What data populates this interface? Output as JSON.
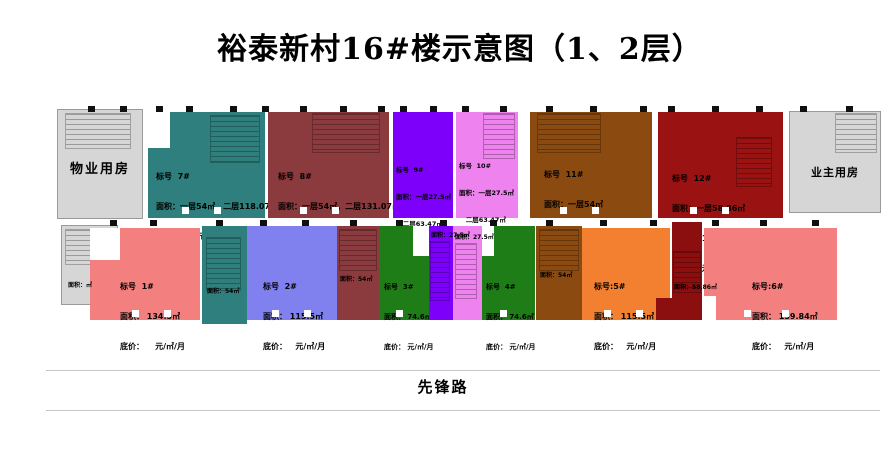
{
  "title": "裕泰新村16#楼示意图（1、2层）",
  "road": {
    "label": "先锋路"
  },
  "rooms": {
    "property": "物业用房",
    "owner": "业主用房"
  },
  "top_units": {
    "u7": {
      "id": "7#",
      "lines": [
        "标号  7#",
        "面积：一层54㎡，二层118.07㎡",
        "底价：      元/㎡/月"
      ]
    },
    "u8": {
      "id": "8#",
      "lines": [
        "标号  8#",
        "面积：一层54㎡，二层131.07㎡",
        "底价：    元/㎡/月"
      ]
    },
    "u9": {
      "id": "9#",
      "lines": [
        "标号  9#",
        "面积：一层27.5㎡",
        "   二层63.47㎡",
        "底价： 元/㎡/月"
      ]
    },
    "u10": {
      "id": "10#",
      "lines": [
        "标号  10#",
        "面积：一层27.5㎡",
        "   二层63.47㎡",
        "底价： 元/㎡/月"
      ]
    },
    "u11": {
      "id": "11#",
      "lines": [
        "标号  11#",
        "面积：一层54㎡",
        "   二层131.07㎡",
        "底价：   元/㎡/月"
      ]
    },
    "u12": {
      "id": "12#",
      "lines": [
        "标号  12#",
        "面积：一层58.86㎡",
        "   二层118㎡",
        "底价：  元/㎡/月"
      ]
    }
  },
  "bottom_units": {
    "u1": {
      "id": "1#",
      "lines": [
        "标号  1#",
        "面积： 134.5㎡",
        "底价：    元/㎡/月"
      ]
    },
    "u2": {
      "id": "2#",
      "lines": [
        "标号  2#",
        "面积： 115.5㎡",
        "底价：   元/㎡/月"
      ]
    },
    "u3": {
      "id": "3#",
      "lines": [
        "标号  3#",
        "面积： 74.6㎡",
        "底价： 元/㎡/月"
      ]
    },
    "u4": {
      "id": "4#",
      "lines": [
        "标号  4#",
        "面积： 74.6㎡",
        "底价： 元/㎡/月"
      ]
    },
    "u5": {
      "id": "5#",
      "lines": [
        "标号:5#",
        "面积： 115.5㎡",
        "底价：   元/㎡/月"
      ]
    },
    "u6": {
      "id": "6#",
      "lines": [
        "标号:6#",
        "面积： 159.84㎡",
        "底价：   元/㎡/月"
      ]
    }
  },
  "ground_areas": {
    "left": "面积：㎡",
    "g7": "面积：54㎡",
    "g8": "面积：54㎡",
    "g9": "面积：27.5㎡",
    "g10": "面积：27.5㎡",
    "g11": "面积：54㎡",
    "g12": "面积：58.86㎡"
  },
  "colors": {
    "teal": "#2e7f7d",
    "maroon": "#8b3a3e",
    "violet": "#7d00fa",
    "orchid": "#ee82ee",
    "brown": "#8b4a10",
    "darkred": "#9a1212",
    "darkred2": "#8b0f0f",
    "salmon": "#f47f7f",
    "periwinkle": "#8080ee",
    "green": "#1e7d16",
    "orange": "#f28030",
    "gray": "#d6d6d6"
  }
}
